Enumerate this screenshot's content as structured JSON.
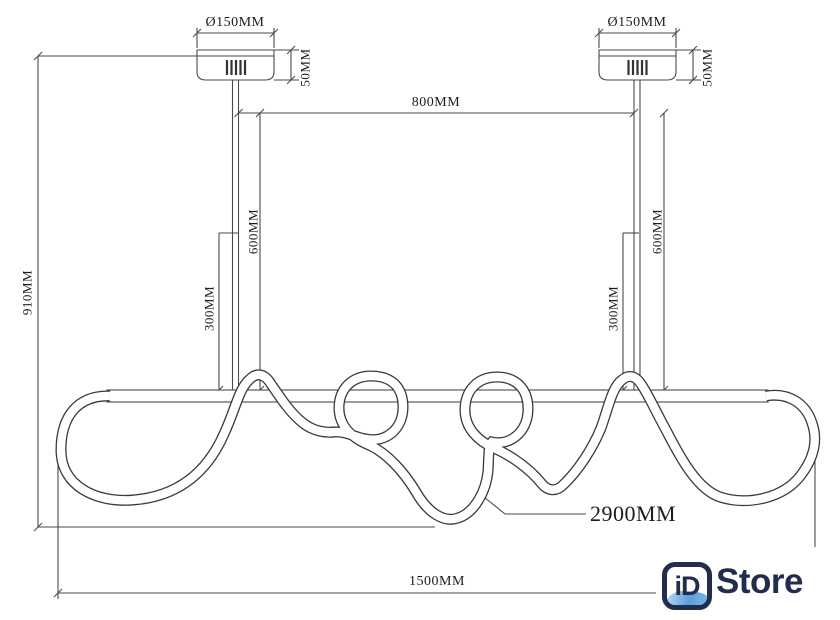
{
  "dimensions": {
    "canopy_diameter_left": "Ø150MM",
    "canopy_diameter_right": "Ø150MM",
    "canopy_height_left": "50MM",
    "canopy_height_right": "50MM",
    "rod_spacing": "800MM",
    "overall_height": "910MM",
    "rod_length_left": "600MM",
    "rod_length_right": "600MM",
    "rod_section_left": "300MM",
    "rod_section_right": "300MM",
    "tube_length": "2900MM",
    "overall_width": "1500MM"
  },
  "logo": {
    "badge": "iD",
    "name": "Store",
    "navy": "#222d4d",
    "blue": "#5d9fd8"
  },
  "drawing": {
    "line_color": "#4a4a4a",
    "tube_color": "#3a3a3a",
    "background": "#ffffff"
  }
}
